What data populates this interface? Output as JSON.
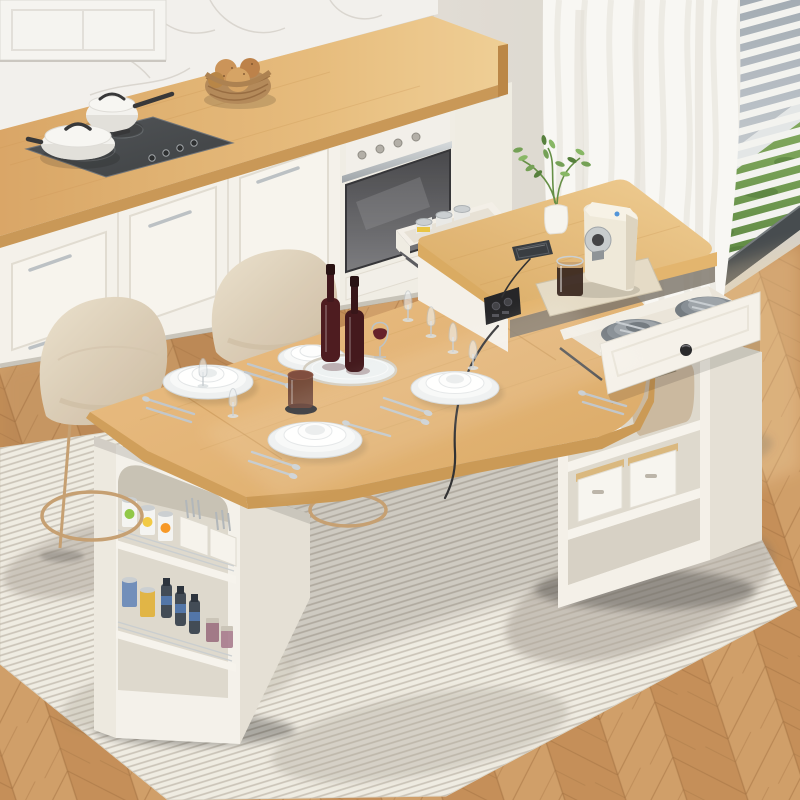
{
  "scene": {
    "subject": "Product photo: extendable kitchen island dining table with storage pedestals, set for four, in a modern white kitchen",
    "objects": [
      "kitchen-counter",
      "induction-cooktop",
      "white-saucepan",
      "white-lidded-pan",
      "bread-basket",
      "built-in-oven",
      "marble-backsplash",
      "window-blinds",
      "sheer-curtain",
      "herringbone-wood-floor",
      "striped-area-rug",
      "upholstered-bar-stool",
      "upholstered-bar-stool-2",
      "dining-tabletop",
      "island-riser-top",
      "left-storage-pedestal",
      "right-storage-pedestal",
      "open-side-drawer-cans",
      "open-utensil-drawer",
      "power-outlet-usb",
      "smartphone",
      "espresso-machine",
      "coffee-glass",
      "potted-plant",
      "mirror-tray",
      "wine-bottles",
      "red-wine-glass",
      "brown-tumbler",
      "plate-stacks",
      "cutlery-sets",
      "champagne-flutes",
      "canned-goods",
      "utensil-caddies",
      "toaster",
      "storage-bins",
      "white-bowls"
    ],
    "counts": {
      "bar_stools": 2,
      "place_settings": 4,
      "wine_bottles": 2,
      "champagne_flutes": 6,
      "open_drawers": 2
    }
  },
  "palette": {
    "wall": "#EBE7E0",
    "wall_shade": "#DFDAD2",
    "marble": "#F2F0ED",
    "marble_vein": "#CCC6BF",
    "panel_white": "#F5F4F1",
    "cabinet": "#F4F1EA",
    "cabinet_shade": "#EFEBE2",
    "cabinet_line": "#DDD7CC",
    "toe_kick": "#9A9388",
    "counter_wood": "#DFAD6B",
    "counter_edge": "#C79350",
    "counter_end": "#B8813F",
    "cooktop": "#43464A",
    "steel": "#C3C8CC",
    "oven_fascia": "#F2EFE9",
    "table_wood": "#E4B677",
    "table_edge": "#C9954F",
    "table_edge_left": "#CE9A54",
    "seam": "#C28C49",
    "island_white": "#F4F0E8",
    "island_shade": "#E4DFD4",
    "cavity": "#DDD7CC",
    "shelf_board": "#F6F3EC",
    "chair_fabric": "#E2D5BF",
    "chair_shade": "#CBB89E",
    "chair_leg": "#C39B6C",
    "rug": "#EFEBE2",
    "rug_stripe": "#A79F91",
    "rug_patch": "#6F675C",
    "floor": "#CE9A62",
    "floor_dark": "#C28A52",
    "floor_line": "#A06C3A",
    "blind_slat": "#F3F3F0",
    "sky": "#A3ACB5",
    "hedge": "#6E9A48",
    "window_frame": "#3E4347",
    "curtain": "#F8F7F4",
    "curtain_fold": "#E6E2DA",
    "plate": "#FBFCFC",
    "plate_shadow": "#D2D6D8",
    "cutlery": "#C2C8CD",
    "wine_bottle": "#451016",
    "wine": "#5E1620",
    "tumbler": "#5E3328",
    "tray_mirror": "#EDF1F2",
    "machine_cream": "#EFE8D9",
    "machine_tray": "#E4DAC4",
    "coffee": "#2E1A12",
    "outlet_black": "#1B1B1E",
    "knob_black": "#1F1F22",
    "drawer_plate": "#828A91",
    "plant_green": "#6E9C4F",
    "plant_dark": "#4E7A34",
    "vase": "#F6F4EF",
    "basket": "#B08453",
    "bread": "#C98F52",
    "can_silver": "#C9CDD0",
    "toaster": "#C9B69B",
    "bin_lid": "#D9B579",
    "shadow": "#3E3830"
  },
  "window_blinds": {
    "slat_count": 19,
    "slat_step": 15.2,
    "slat_drop": 29,
    "slat_thickness": 7.4
  },
  "decor": {
    "rug_stripe_angle": -17,
    "floor_angle": -18
  }
}
